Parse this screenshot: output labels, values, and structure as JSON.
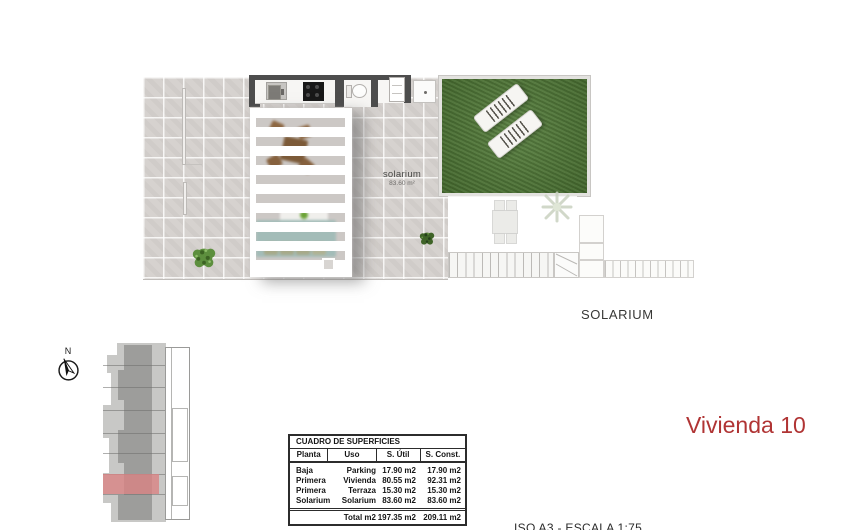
{
  "plan": {
    "solarium_inplan_label": "solarium",
    "solarium_inplan_area": "83.60 m²",
    "section_label": "SOLARIUM"
  },
  "compass": {
    "north_label": "N"
  },
  "sheet_title": {
    "text": "Vivienda 10",
    "color": "#b03434"
  },
  "footer": {
    "scale_text": "ISO A3 - ESCALA 1:75"
  },
  "surfaces_table": {
    "title": "CUADRO DE SUPERFICIES",
    "headers": [
      "Planta",
      "Uso",
      "S. Útil",
      "S. Const."
    ],
    "rows": [
      {
        "planta": "Baja",
        "uso": "Parking",
        "util": "17.90 m2",
        "const": "17.90 m2"
      },
      {
        "planta": "Primera",
        "uso": "Vivienda",
        "util": "80.55 m2",
        "const": "92.31 m2"
      },
      {
        "planta": "Primera",
        "uso": "Terraza",
        "util": "15.30 m2",
        "const": "15.30 m2"
      },
      {
        "planta": "Solarium",
        "uso": "Solarium",
        "util": "83.60 m2",
        "const": "83.60 m2"
      }
    ],
    "total": {
      "label": "Total m2",
      "util": "197.35 m2",
      "const": "209.11 m2"
    }
  },
  "colors": {
    "title_red": "#b03434",
    "highlight_red": "#d98383",
    "grass_green": "#4e7834",
    "wall_gray": "#4d4d4d",
    "tile_gray": "#d6d2cf"
  }
}
